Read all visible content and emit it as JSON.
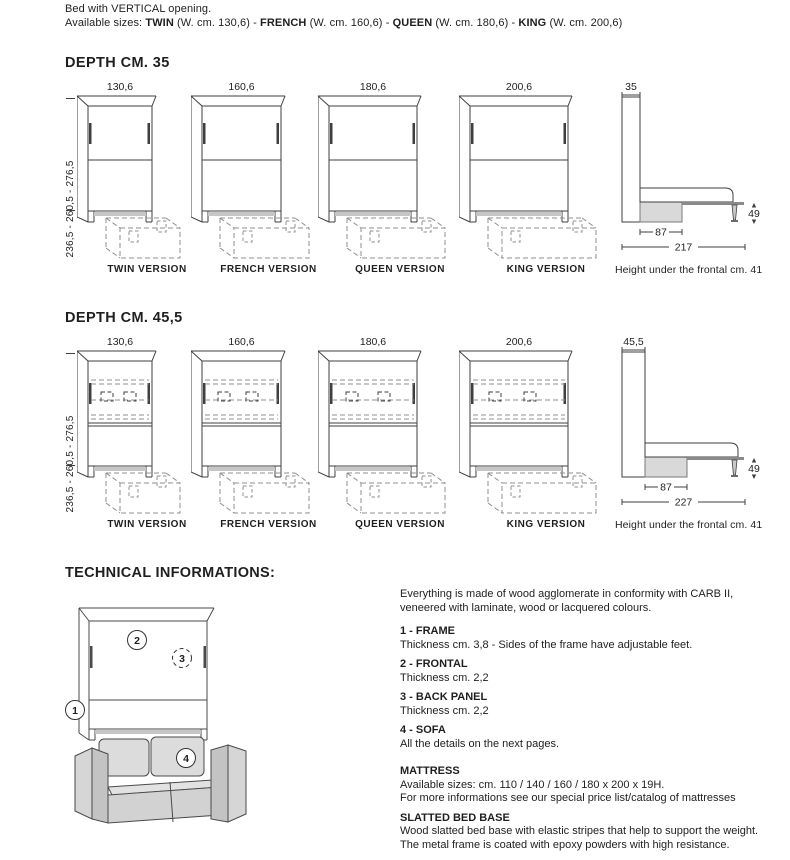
{
  "colors": {
    "line": "#3f3f3f",
    "dash": "#8f8f8f",
    "gray_fill": "#d9d9d9",
    "gray_strip": "#c6c6c6",
    "sofa_light": "#d6d6d6",
    "sofa_dark": "#c3c3c3",
    "text": "#1f1f1f"
  },
  "intro": {
    "line1": "Bed with VERTICAL opening.",
    "line2_segments": [
      {
        "t": "Available sizes: ",
        "b": false
      },
      {
        "t": "TWIN",
        "b": true
      },
      {
        "t": " (W. cm. 130,6) - ",
        "b": false
      },
      {
        "t": "FRENCH",
        "b": true
      },
      {
        "t": " (W. cm. 160,6) - ",
        "b": false
      },
      {
        "t": "QUEEN",
        "b": true
      },
      {
        "t": " (W. cm. 180,6) - ",
        "b": false
      },
      {
        "t": "KING",
        "b": true
      },
      {
        "t": " (W. cm. 200,6)",
        "b": false
      }
    ]
  },
  "sections": [
    {
      "title": "DEPTH CM. 35",
      "height_label": "236,5 - 260,5 - 276,5",
      "interior": "plain",
      "figures": [
        {
          "version": "TWIN VERSION",
          "width_cm": "130,6"
        },
        {
          "version": "FRENCH VERSION",
          "width_cm": "160,6"
        },
        {
          "version": "QUEEN VERSION",
          "width_cm": "180,6"
        },
        {
          "version": "KING VERSION",
          "width_cm": "200,6"
        }
      ],
      "side_view": {
        "depth_cm": "35",
        "sofa_depth_cm": "87",
        "open_depth_cm": "217",
        "height_cm": "49",
        "caption": "Height under the frontal cm. 41"
      }
    },
    {
      "title": "DEPTH CM. 45,5",
      "height_label": "236,5 - 260,5 - 276,5",
      "interior": "shelves",
      "figures": [
        {
          "version": "TWIN VERSION",
          "width_cm": "130,6"
        },
        {
          "version": "FRENCH VERSION",
          "width_cm": "160,6"
        },
        {
          "version": "QUEEN VERSION",
          "width_cm": "180,6"
        },
        {
          "version": "KING VERSION",
          "width_cm": "200,6"
        }
      ],
      "side_view": {
        "depth_cm": "45,5",
        "sofa_depth_cm": "87",
        "open_depth_cm": "227",
        "height_cm": "49",
        "caption": "Height under the frontal cm. 41"
      }
    }
  ],
  "technical": {
    "title": "TECHNICAL INFORMATIONS:",
    "intro_lines": [
      "Everything is made of wood agglomerate in conformity with CARB II,",
      "veneered with laminate, wood or lacquered colours."
    ],
    "items": [
      {
        "title": "1 - FRAME",
        "lines": [
          "Thickness cm. 3,8 - Sides of the frame have adjustable feet."
        ]
      },
      {
        "title": "2 - FRONTAL",
        "lines": [
          "Thickness cm. 2,2"
        ]
      },
      {
        "title": "3 - BACK PANEL",
        "lines": [
          "Thickness cm. 2,2"
        ]
      },
      {
        "title": "4 - SOFA",
        "lines": [
          "All the details on the next pages."
        ]
      },
      {
        "title": "MATTRESS",
        "gap_before": true,
        "lines": [
          "Available sizes: cm. 110 / 140 / 160 / 180 x 200 x 19H.",
          "For more informations see our special price list/catalog of mattresses"
        ]
      },
      {
        "title": "SLATTED BED BASE",
        "lines": [
          "Wood slatted bed base with elastic stripes that help to support the weight.",
          "The metal frame is coated with epoxy powders with high resistance."
        ]
      }
    ],
    "callouts": [
      "1",
      "2",
      "3",
      "4"
    ]
  }
}
